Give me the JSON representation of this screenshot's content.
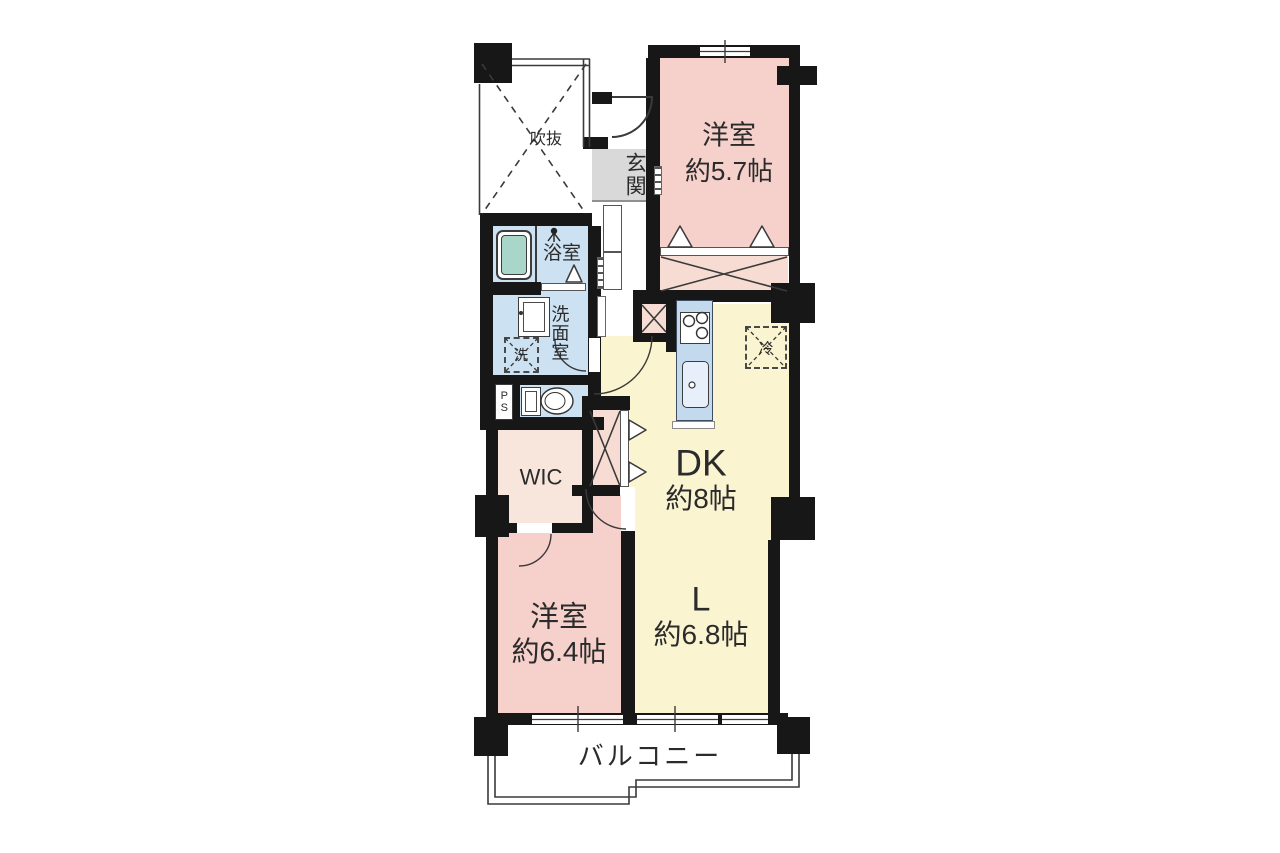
{
  "floorplan": {
    "type": "apartment-floor-plan",
    "rooms": {
      "western_5_7": {
        "label": "洋室",
        "size": "約5.7帖"
      },
      "dining_kitchen": {
        "label": "DK",
        "size": "約8帖"
      },
      "living": {
        "label": "L",
        "size": "約6.8帖"
      },
      "western_6_4": {
        "label": "洋室",
        "size": "約6.4帖"
      },
      "walk_in_closet": {
        "label": "WIC"
      },
      "entrance": {
        "label": "玄関"
      },
      "bathroom": {
        "label": "浴室"
      },
      "washroom": {
        "label": "洗面室"
      },
      "void": {
        "label": "吹抜"
      },
      "balcony": {
        "label": "バルコニー"
      }
    },
    "fixtures": {
      "washing_machine": {
        "label": "洗"
      },
      "refrigerator": {
        "label": "冷"
      },
      "pipe_space": {
        "label": "PS"
      }
    },
    "colors": {
      "bg": "#ffffff",
      "wall": "#171717",
      "room_pink": "#f6d1cc",
      "closet_pink": "#f7dcd4",
      "wic_pink": "#f8e5dc",
      "lk_yellow": "#faf4d0",
      "wet_blue": "#cce1f1",
      "counter_blue": "#c3d9ed",
      "bathtub_teal": "#a9d6c9",
      "entrance_gray": "#d9d9d9",
      "line": "#3a3a3a"
    }
  }
}
